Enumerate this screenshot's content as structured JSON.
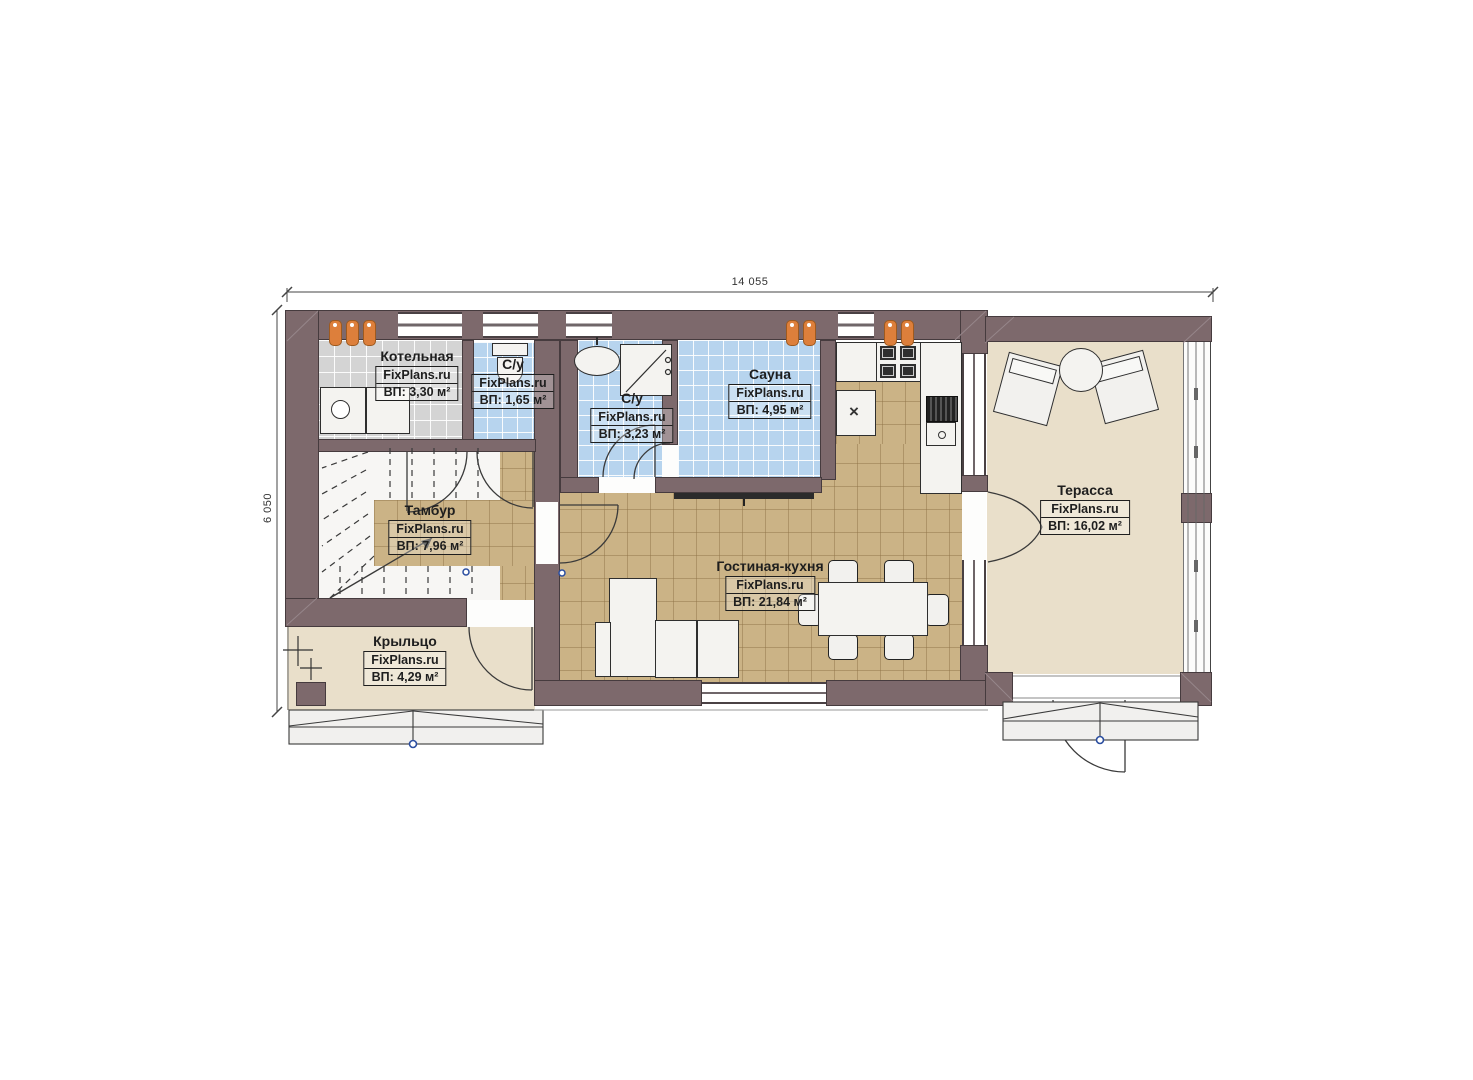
{
  "plan": {
    "dimensions": {
      "width": "14 055",
      "height": "6 050"
    },
    "rooms": [
      {
        "id": "kotelnaya",
        "name": "Котельная",
        "brand": "FixPlans.ru",
        "area": "ВП: 3,30 м²"
      },
      {
        "id": "su-1",
        "name": "С/у",
        "brand": "FixPlans.ru",
        "area": "ВП: 1,65 м²"
      },
      {
        "id": "su-2",
        "name": "С/у",
        "brand": "FixPlans.ru",
        "area": "ВП: 3,23 м²"
      },
      {
        "id": "sauna",
        "name": "Сауна",
        "brand": "FixPlans.ru",
        "area": "ВП: 4,95 м²"
      },
      {
        "id": "tambur",
        "name": "Тамбур",
        "brand": "FixPlans.ru",
        "area": "ВП: 7,96 м²"
      },
      {
        "id": "gostinaya-kuhnya",
        "name": "Гостиная-кухня",
        "brand": "FixPlans.ru",
        "area": "ВП: 21,84 м²"
      },
      {
        "id": "terassa",
        "name": "Терасса",
        "brand": "FixPlans.ru",
        "area": "ВП: 16,02 м²"
      },
      {
        "id": "krylco",
        "name": "Крыльцо",
        "brand": "FixPlans.ru",
        "area": "ВП: 4,29 м²"
      }
    ],
    "symbols": {
      "cross": "×"
    },
    "colors": {
      "wall": "#7d696c",
      "floor_tile_tan": "#cbb386",
      "floor_tile_blue": "#b7d4ee",
      "floor_tile_gray": "#d4d4d4",
      "floor_deck_beige": "#e9dfca",
      "radiator_orange": "#dd7f3b",
      "marker_blue": "#2b4ea0"
    }
  }
}
